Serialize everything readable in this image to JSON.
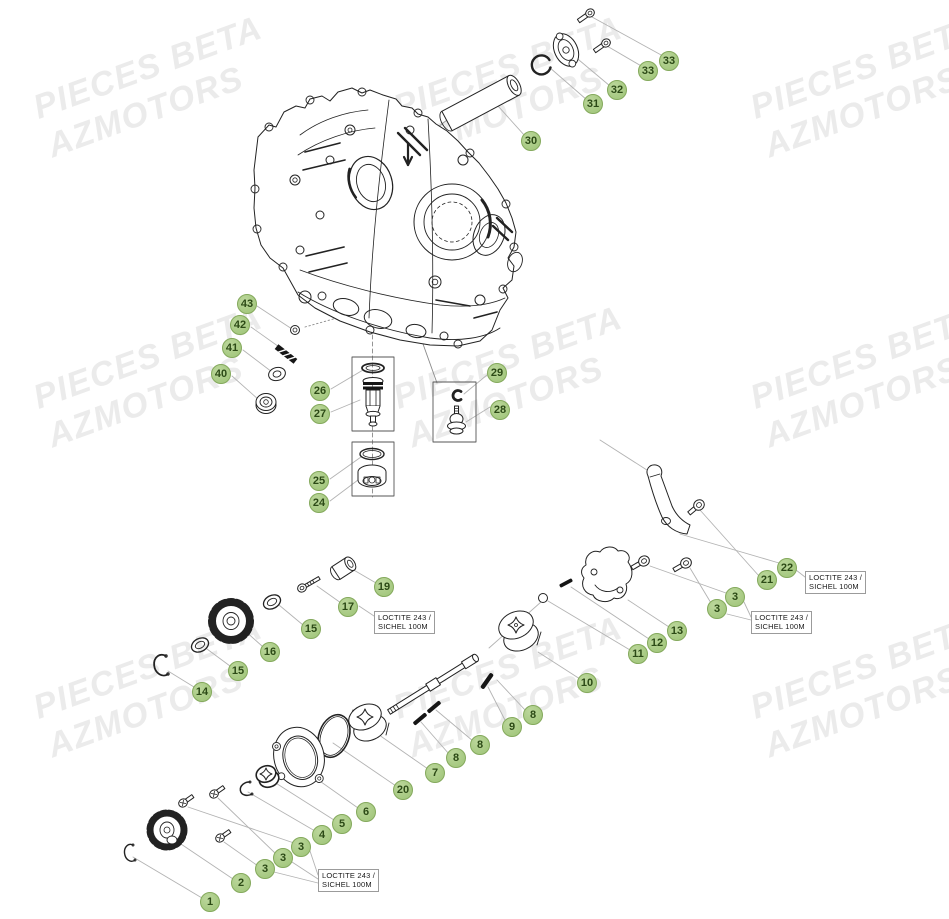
{
  "page": {
    "background": "#ffffff",
    "width": 949,
    "height": 919
  },
  "watermark": {
    "line1": "PIECES BETA",
    "line2": "AZMOTORS",
    "color": "#ebebeb",
    "rotation_deg": -20,
    "positions": [
      [
        28,
        90
      ],
      [
        388,
        90
      ],
      [
        745,
        90
      ],
      [
        28,
        380
      ],
      [
        388,
        380
      ],
      [
        745,
        380
      ],
      [
        28,
        690
      ],
      [
        388,
        690
      ],
      [
        745,
        690
      ]
    ]
  },
  "callouts": {
    "fill": "#a6c981",
    "fill_light": "#bcd79c",
    "border": "#84a95c",
    "text_color": "#2c4a16",
    "diameter": 20,
    "items": [
      {
        "label": "30",
        "x": 531,
        "y": 141
      },
      {
        "label": "31",
        "x": 593,
        "y": 104
      },
      {
        "label": "32",
        "x": 617,
        "y": 90
      },
      {
        "label": "33",
        "x": 648,
        "y": 71
      },
      {
        "label": "33",
        "x": 669,
        "y": 61
      },
      {
        "label": "43",
        "x": 247,
        "y": 304
      },
      {
        "label": "42",
        "x": 240,
        "y": 325
      },
      {
        "label": "41",
        "x": 232,
        "y": 348
      },
      {
        "label": "40",
        "x": 221,
        "y": 374
      },
      {
        "label": "26",
        "x": 320,
        "y": 391
      },
      {
        "label": "27",
        "x": 320,
        "y": 414
      },
      {
        "label": "29",
        "x": 497,
        "y": 373
      },
      {
        "label": "28",
        "x": 500,
        "y": 410
      },
      {
        "label": "25",
        "x": 319,
        "y": 481
      },
      {
        "label": "24",
        "x": 319,
        "y": 503
      },
      {
        "label": "19",
        "x": 384,
        "y": 587
      },
      {
        "label": "17",
        "x": 348,
        "y": 607
      },
      {
        "label": "15",
        "x": 311,
        "y": 629
      },
      {
        "label": "16",
        "x": 270,
        "y": 652
      },
      {
        "label": "15",
        "x": 238,
        "y": 671
      },
      {
        "label": "14",
        "x": 202,
        "y": 692
      },
      {
        "label": "22",
        "x": 787,
        "y": 568
      },
      {
        "label": "21",
        "x": 767,
        "y": 580
      },
      {
        "label": "3",
        "x": 735,
        "y": 597
      },
      {
        "label": "3",
        "x": 717,
        "y": 609
      },
      {
        "label": "13",
        "x": 677,
        "y": 631
      },
      {
        "label": "12",
        "x": 657,
        "y": 643
      },
      {
        "label": "11",
        "x": 638,
        "y": 654
      },
      {
        "label": "10",
        "x": 587,
        "y": 683
      },
      {
        "label": "8",
        "x": 533,
        "y": 715
      },
      {
        "label": "9",
        "x": 512,
        "y": 727
      },
      {
        "label": "8",
        "x": 480,
        "y": 745
      },
      {
        "label": "8",
        "x": 456,
        "y": 758
      },
      {
        "label": "7",
        "x": 435,
        "y": 773
      },
      {
        "label": "20",
        "x": 403,
        "y": 790
      },
      {
        "label": "6",
        "x": 366,
        "y": 812
      },
      {
        "label": "5",
        "x": 342,
        "y": 824
      },
      {
        "label": "4",
        "x": 322,
        "y": 835
      },
      {
        "label": "3",
        "x": 301,
        "y": 847
      },
      {
        "label": "3",
        "x": 283,
        "y": 858
      },
      {
        "label": "3",
        "x": 265,
        "y": 869
      },
      {
        "label": "2",
        "x": 241,
        "y": 883
      },
      {
        "label": "1",
        "x": 210,
        "y": 902
      }
    ]
  },
  "notes": {
    "border_color": "#9b9b9b",
    "text_color": "#1a1a1a",
    "items": [
      {
        "line1": "LOCTITE 243 /",
        "line2": "SICHEL 100M",
        "x": 374,
        "y": 611
      },
      {
        "line1": "LOCTITE 243 /",
        "line2": "SICHEL 100M",
        "x": 805,
        "y": 571
      },
      {
        "line1": "LOCTITE 243 /",
        "line2": "SICHEL 100M",
        "x": 751,
        "y": 611
      },
      {
        "line1": "LOCTITE 243 /",
        "line2": "SICHEL 100M",
        "x": 318,
        "y": 869
      }
    ]
  }
}
